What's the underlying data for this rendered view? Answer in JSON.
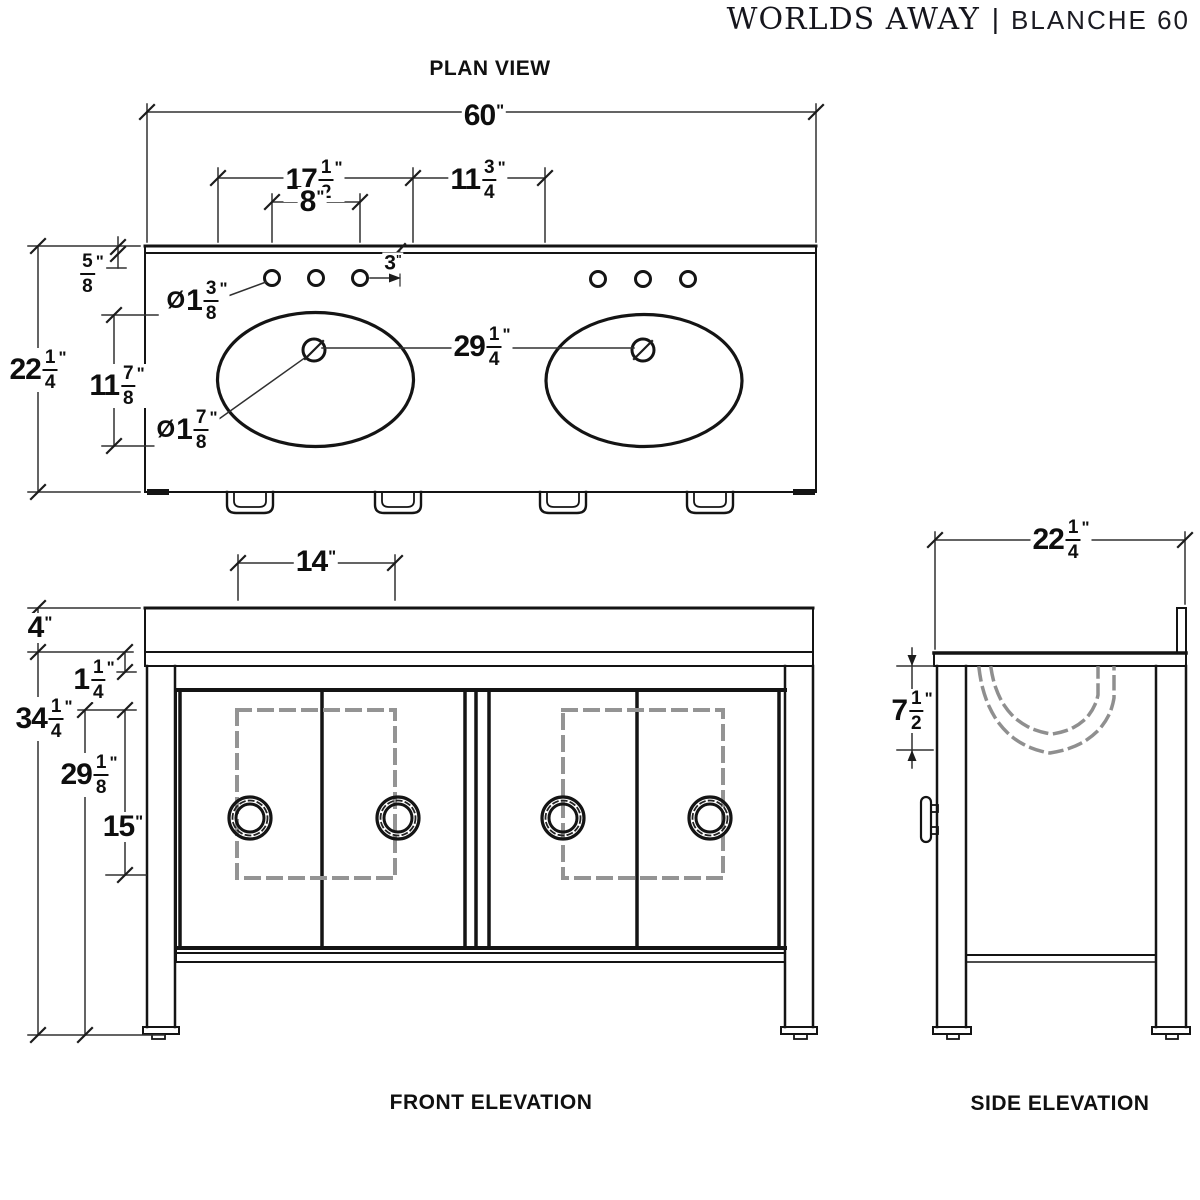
{
  "header": {
    "brand": "WORLDS AWAY",
    "separator": "|",
    "product": "BLANCHE 60"
  },
  "unit": "\"",
  "views": {
    "plan": {
      "title": "PLAN VIEW",
      "dims": {
        "overall_width": "60",
        "sink_cutout_width": "17 1/2",
        "between_sinks": "11 3/4",
        "faucet_spread": "8",
        "hole_offset": "3",
        "counter_edge": "5/8",
        "overall_depth": "22 1/4",
        "sink_cutout_depth": "11 7/8",
        "faucet_hole_diameter": "Ø1 3/8",
        "drain_hole_diameter": "Ø1 7/8",
        "sink_center_spacing": "29 1/4"
      }
    },
    "front": {
      "title": "FRONT ELEVATION",
      "dims": {
        "door_panel_width": "14",
        "counter_height": "4",
        "apron_height": "1 1/4",
        "overall_height": "34 1/4",
        "base_height": "29 1/8",
        "panel_height": "15"
      }
    },
    "side": {
      "title": "SIDE ELEVATION",
      "dims": {
        "overall_depth": "22 1/4",
        "bowl_depth": "7 1/2"
      }
    }
  }
}
